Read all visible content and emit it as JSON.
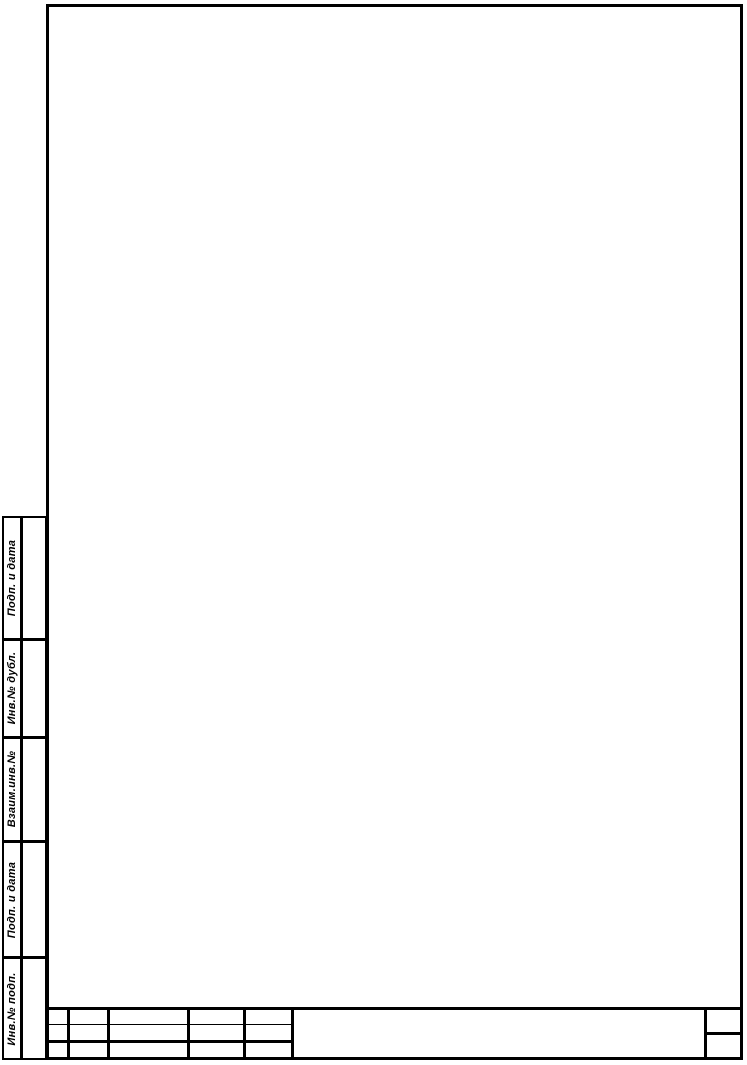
{
  "colors": {
    "paper": "#ffffff",
    "ink": "#000000"
  },
  "sheet": {
    "kind_label": "Blank drawing form sheet"
  },
  "margin_column": {
    "sections": [
      {
        "label": "Подп. и дата"
      },
      {
        "label": "Инв.№ дубл."
      },
      {
        "label": "Взаим.инв.№"
      },
      {
        "label": "Подп. и дата"
      },
      {
        "label": "Инв.№ подп."
      }
    ]
  },
  "title_block": {
    "revision_rows": [
      [
        "",
        "",
        "",
        "",
        ""
      ],
      [
        "",
        "",
        "",
        "",
        ""
      ],
      [
        "",
        "",
        "",
        "",
        ""
      ]
    ],
    "designation": "",
    "corner_top": "",
    "corner_bottom": ""
  }
}
